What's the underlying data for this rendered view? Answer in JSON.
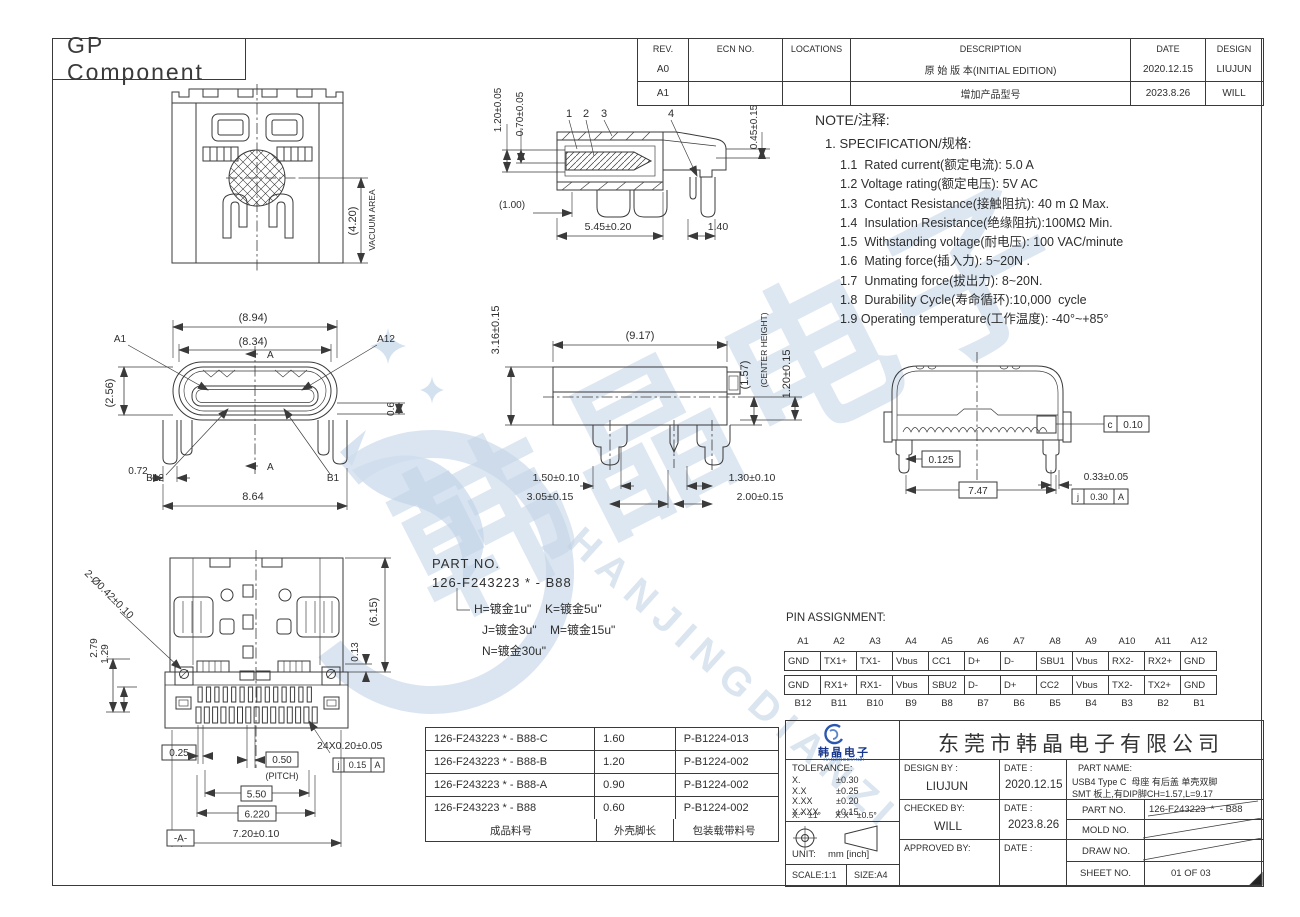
{
  "frame": {
    "sheet_title": "GP Component"
  },
  "colors": {
    "line": "#3a3a3a",
    "watermark": "#c9d9ea",
    "logo_blue": "#17368c"
  },
  "revision_table": {
    "headers": {
      "rev": "REV.",
      "ecn": "ECN NO.",
      "locations": "LOCATIONS",
      "description": "DESCRIPTION",
      "date": "DATE",
      "design": "DESIGN"
    },
    "rows": [
      {
        "rev": "A0",
        "ecn": "",
        "locations": "",
        "description": "原 始 版 本(INITIAL EDITION)",
        "date": "2020.12.15",
        "design": "LIUJUN"
      },
      {
        "rev": "A1",
        "ecn": "",
        "locations": "",
        "description": "增加产品型号",
        "date": "2023.8.26",
        "design": "WILL"
      }
    ]
  },
  "notes": {
    "heading": "NOTE/注释:",
    "spec": "1. SPECIFICATION/规格:",
    "items": [
      "1.1  Rated current(额定电流): 5.0 A",
      "1.2 Voltage rating(额定电压): 5V AC",
      "1.3  Contact Resistance(接触阻抗): 40 m Ω Max.",
      "1.4  Insulation Resistance(绝缘阻抗):100MΩ Min.",
      "1.5  Withstanding voltage(耐电压): 100 VAC/minute",
      "1.6  Mating force(插入力): 5~20N .",
      "1.7  Unmating force(拔出力): 8~20N.",
      "1.8  Durability Cycle(寿命循环):10,000  cycle",
      "1.9 Operating temperature(工作温度): -40°~+85°"
    ]
  },
  "part_no_callout": {
    "label": "PART NO.",
    "number": "126-F243223  *  - B88",
    "opt_h": "H=镀金1u\"",
    "opt_k": "K=镀金5u\"",
    "opt_j": "J=镀金3u\"",
    "opt_m": "M=镀金15u\"",
    "opt_n": "N=镀金30u\""
  },
  "pin_assignment": {
    "heading": "PIN ASSIGNMENT:",
    "columns": [
      {
        "top": "A1",
        "a": "GND",
        "b": "GND",
        "bottom": "B12"
      },
      {
        "top": "A2",
        "a": "TX1+",
        "b": "RX1+",
        "bottom": "B11"
      },
      {
        "top": "A3",
        "a": "TX1-",
        "b": "RX1-",
        "bottom": "B10"
      },
      {
        "top": "A4",
        "a": "Vbus",
        "b": "Vbus",
        "bottom": "B9"
      },
      {
        "top": "A5",
        "a": "CC1",
        "b": "SBU2",
        "bottom": "B8"
      },
      {
        "top": "A6",
        "a": "D+",
        "b": "D-",
        "bottom": "B7"
      },
      {
        "top": "A7",
        "a": "D-",
        "b": "D+",
        "bottom": "B6"
      },
      {
        "top": "A8",
        "a": "SBU1",
        "b": "CC2",
        "bottom": "B5"
      },
      {
        "top": "A9",
        "a": "Vbus",
        "b": "Vbus",
        "bottom": "B4"
      },
      {
        "top": "A10",
        "a": "RX2-",
        "b": "TX2-",
        "bottom": "B3"
      },
      {
        "top": "A11",
        "a": "RX2+",
        "b": "TX2+",
        "bottom": "B2"
      },
      {
        "top": "A12",
        "a": "GND",
        "b": "GND",
        "bottom": "B1"
      }
    ]
  },
  "parts_table": {
    "rows": [
      {
        "part": "126-F243223  *  - B88-C",
        "len": "1.60",
        "pkg": "P-B1224-013"
      },
      {
        "part": "126-F243223  *  - B88-B",
        "len": "1.20",
        "pkg": "P-B1224-002"
      },
      {
        "part": "126-F243223  *  - B88-A",
        "len": "0.90",
        "pkg": "P-B1224-002"
      },
      {
        "part": "126-F243223  *  - B88",
        "len": "0.60",
        "pkg": "P-B1224-002"
      }
    ],
    "footer": {
      "part": "成品料号",
      "len": "外壳脚长",
      "pkg": "包装载带料号"
    }
  },
  "title_block": {
    "logo_text": "韩晶电子",
    "logo_sub": "HANJINGDIANZI",
    "company": "东莞市韩晶电子有限公司",
    "tolerance_heading": "TOLERANCE:",
    "tolerance_rows": [
      {
        "k": "X.",
        "v": "±0.30"
      },
      {
        "k": "X.X",
        "v": "±0.25"
      },
      {
        "k": "X.XX",
        "v": "±0.20"
      },
      {
        "k": "X.XXX",
        "v": "±0.15"
      }
    ],
    "tolerance_angles": "X.°  ±1°      X.X°  ±0.5°",
    "unit_label": "UNIT:",
    "unit_value": "mm [inch]",
    "scale": "SCALE:1:1",
    "size": "SIZE:A4",
    "design_by_label": "DESIGN BY :",
    "design_by": "LIUJUN",
    "date_label": "DATE :",
    "design_date": "2020.12.15",
    "checked_by_label": "CHECKED BY:",
    "checked_by": "WILL",
    "checked_date": "2023.8.26",
    "approved_by_label": "APPROVED BY:",
    "part_name_label": "PART NAME:",
    "part_name_line1": "USB4 Type C  母座 有后盖 单壳双脚",
    "part_name_line2": "SMT 板上,有DIP脚CH=1.57,L=9.17",
    "part_no_label": "PART NO.",
    "part_no_value": "126-F243223  *  - B88",
    "mold_no_label": "MOLD NO.",
    "draw_no_label": "DRAW NO.",
    "sheet_no_label": "SHEET NO.",
    "sheet_no_value": "01 OF 03"
  },
  "views": {
    "top": {
      "dim_vacuum": "(4.20)",
      "vacuum_label": "VACUUM AREA"
    },
    "section": {
      "c1": "1",
      "c2": "2",
      "c3": "3",
      "c4": "4",
      "dim_tongue_h": "1.20±0.05",
      "dim_tip_h": "0.70±0.05",
      "dim_pin": "0.45±0.15",
      "dim_offset": "(1.00)",
      "dim_depth": "5.45±0.20",
      "dim_pitch": "1.40"
    },
    "front": {
      "dim_w_outer": "(8.94)",
      "dim_w_shell": "(8.34)",
      "dim_h": "(2.56)",
      "dim_step": "0.6",
      "dim_leg": "0.72",
      "dim_w": "8.64",
      "pin_a1": "A1",
      "pin_a12": "A12",
      "pin_b12": "B12",
      "pin_b1": "B1",
      "section_mark": "A"
    },
    "side": {
      "dim_h": "3.16±0.15",
      "dim_len": "(9.17)",
      "dim_ch": "(1.57)",
      "center_height": "(CENTER HEIGHT)",
      "dim_tail": "1.20±0.15",
      "dim_leg1": "1.50±0.10",
      "dim_leg2": "3.05±0.15",
      "dim_leg3": "1.30±0.10",
      "dim_leg4": "2.00±0.15"
    },
    "rear": {
      "fcf1_sym": "c",
      "fcf1_val": "0.10",
      "dim_foot": "0.125",
      "dim_span": "7.47",
      "dim_pin": "0.33±0.05",
      "fcf2_sym": "j",
      "fcf2_val": "0.30",
      "fcf2_datum": "A"
    },
    "bottom": {
      "dim_holes": "2-Ø0.42±0.10",
      "dim_v1": "2.79",
      "dim_v2": "1.29",
      "dim_body": "(6.15)",
      "dim_edge": "0.13",
      "dim_pad": "0.25",
      "dim_pitch": "0.50",
      "pitch_label": "(PITCH)",
      "dim_pads": "24X0.20±0.05",
      "fcf_sym": "j",
      "fcf_val": "0.15",
      "fcf_datum": "A",
      "dim_row1": "5.50",
      "dim_row2": "6.220",
      "dim_width": "7.20±0.10",
      "datum_flag": "-A-"
    }
  },
  "watermark": {
    "cjk": "韩晶电子",
    "latin": "HANJINGDIANZI"
  }
}
